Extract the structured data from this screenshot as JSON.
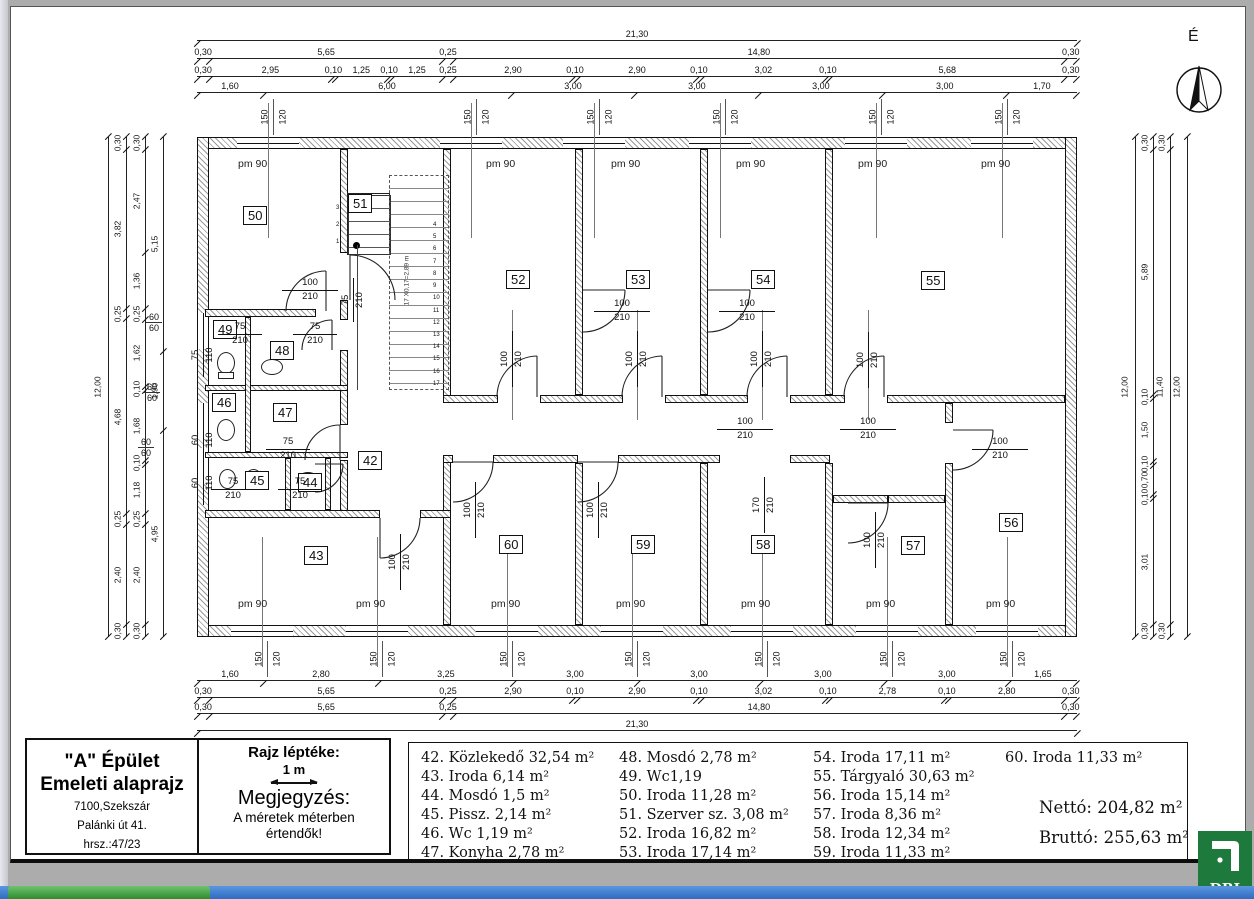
{
  "north": {
    "label": "É"
  },
  "title_block": {
    "line1": "\"A\" Épület",
    "line2": "Emeleti alaprajz",
    "line3": "7100,Szekszár",
    "line4": "Palánki út 41.",
    "line5": "hrsz.:47/23"
  },
  "scale_block": {
    "title": "Rajz léptéke:",
    "scale": "1 m",
    "note_title": "Megjegyzés:",
    "note_line1": "A méretek méterben",
    "note_line2": "értendők!"
  },
  "legend": {
    "columns": [
      [
        "42. Közlekedő 32,54 m²",
        "43. Iroda 6,14 m²",
        "44. Mosdó 1,5 m²",
        "45. Pissz. 2,14 m²",
        "46. Wc 1,19 m²",
        "47. Konyha 2,78 m²"
      ],
      [
        "48. Mosdó 2,78 m²",
        "49. Wc1,19",
        "50. Iroda 11,28 m²",
        "51. Szerver sz. 3,08 m²",
        "52. Iroda 16,82 m²",
        "53. Iroda 17,14 m²"
      ],
      [
        "54. Iroda 17,11 m²",
        "55. Tárgyaló 30,63 m²",
        "56. Iroda 15,14 m²",
        "57. Iroda 8,36 m²",
        "58. Iroda 12,34 m²",
        "59. Iroda 11,33 m²"
      ],
      [
        "60. Iroda 11,33 m²"
      ]
    ]
  },
  "totals": {
    "netto": "Nettó: 204,82 m²",
    "brutto": "Bruttó: 255,63 m²"
  },
  "logo": {
    "text": "DBI"
  },
  "plan": {
    "rooms": {
      "42": "42",
      "43": "43",
      "44": "44",
      "45": "45",
      "46": "46",
      "47": "47",
      "48": "48",
      "49": "49",
      "50": "50",
      "51": "51",
      "52": "52",
      "53": "53",
      "54": "54",
      "55": "55",
      "56": "56",
      "57": "57",
      "58": "58",
      "59": "59",
      "60": "60"
    },
    "win_label": "pm 90",
    "stair_note": "17 X0,17=2,89 m",
    "stair_numbers_top": [
      "3",
      "2",
      "1"
    ],
    "stair_numbers_side": [
      "4",
      "5",
      "6",
      "7",
      "8",
      "9",
      "10",
      "11",
      "12",
      "13",
      "14",
      "15",
      "16",
      "17"
    ]
  },
  "sizes": {
    "w150": "150",
    "h120": "120",
    "s60": "60",
    "w110": "110",
    "w75": "75",
    "w100": "100",
    "h210": "210",
    "w170": "170"
  },
  "dims": {
    "top": [
      [
        "21,30"
      ],
      [
        "0,30",
        "5,65",
        "0,25",
        "14,80",
        "0,30"
      ],
      [
        "0,30",
        "2,95",
        "0,10",
        "1,25",
        "0,10",
        "1,25",
        "0,25",
        "2,90",
        "0,10",
        "2,90",
        "0,10",
        "3,02",
        "0,10",
        "5,68",
        "0,30"
      ],
      [
        "1,60",
        "6,00",
        "3,00",
        "3,00",
        "3,00",
        "3,00",
        "1,70"
      ]
    ],
    "bottom": [
      [
        "1,60",
        "2,80",
        "3,25",
        "3,00",
        "3,00",
        "3,00",
        "3,00",
        "1,65"
      ],
      [
        "0,30",
        "5,65",
        "0,25",
        "2,90",
        "0,10",
        "2,90",
        "0,10",
        "3,02",
        "0,10",
        "2,78",
        "0,10",
        "2,80",
        "0,30"
      ],
      [
        "0,30",
        "5,65",
        "0,25",
        "14,80",
        "0,30"
      ],
      [
        "21,30"
      ]
    ],
    "left": [
      [
        "12,00"
      ],
      [
        "0,30",
        "3,82",
        "0,25",
        "4,68",
        "0,25",
        "2,40",
        "0,30"
      ],
      [
        "0,30",
        "2,47",
        "1,36",
        "0,25",
        "1,62",
        "0,10",
        "1,68",
        "0,10",
        "1,18",
        "0,25",
        "2,40",
        "0,30"
      ],
      [
        "5,15",
        "1,90",
        "4,95"
      ]
    ],
    "right": [
      [
        "12,00"
      ],
      [
        "0,30",
        "5,89",
        "0,10",
        "1,50",
        "0,10",
        "0,70",
        "0,10",
        "3,01",
        "0,30"
      ],
      [
        "0,30",
        "11,40",
        "0,30"
      ],
      [
        "12,00"
      ]
    ]
  }
}
